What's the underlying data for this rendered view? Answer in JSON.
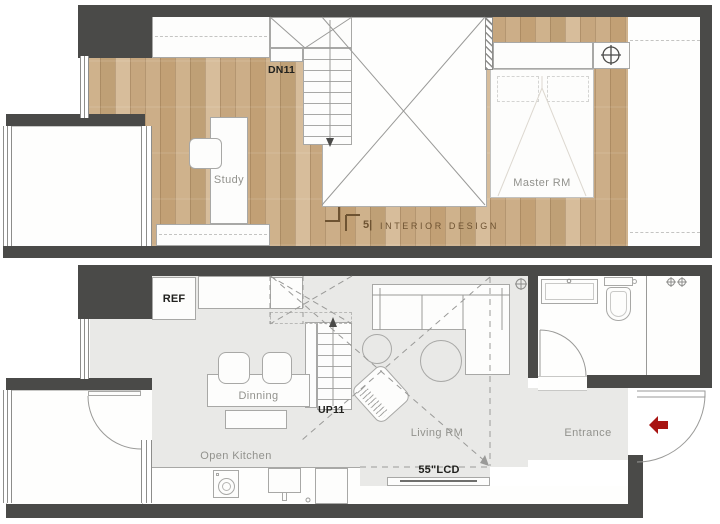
{
  "title": "Two-level loft apartment floor plan (upper and lower level)",
  "colors": {
    "wall": "#4a4a48",
    "wood_floor": "#c9ac87",
    "gray_floor": "#e9e9e7",
    "line": "#a8a8a6",
    "label_gray": "#92928d",
    "label_dark": "#21211e",
    "watermark_brown": "#6e5332",
    "entry_arrow_red": "#a81412"
  },
  "upper": {
    "stair_label": "DN11",
    "study_label": "Study",
    "master_label": "Master  RM",
    "watermark_mark": "5|",
    "watermark_text": "INTERIOR   DESIGN"
  },
  "lower": {
    "ref_label": "REF",
    "dining_label": "Dinning",
    "stair_label": "UP11",
    "kitchen_label": "Open Kitchen",
    "living_label": "Living RM",
    "tv_label": "55\"LCD",
    "entrance_label": "Entrance"
  },
  "icons": {
    "downlight_icon": "circle-cross ceiling light",
    "entry_arrow_icon": "red arrow pointing left (entry direction)",
    "stair_down_arrow_icon": "down arrow",
    "stair_up_arrow_icon": "up arrow",
    "shower_mixer_icon": "two valve handles",
    "door_swing_icon": "quarter-circle door arc"
  }
}
